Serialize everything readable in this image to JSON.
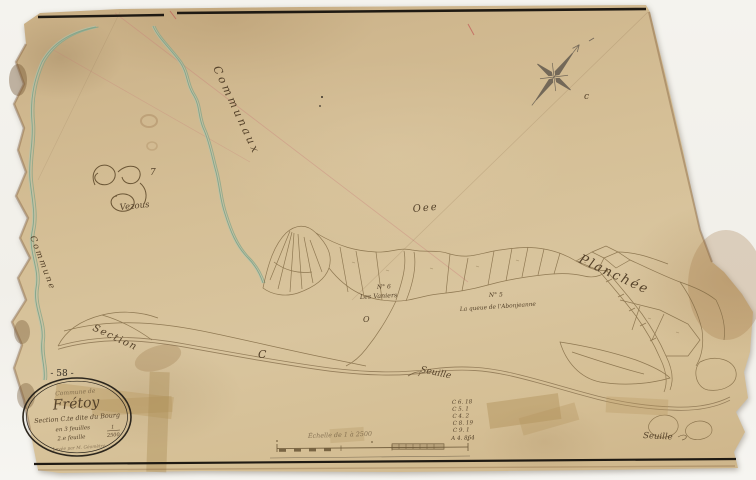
{
  "map": {
    "sheet_number": "- 58 -",
    "cartouche": {
      "commune_line": "Commune de",
      "title": "Frétoy",
      "section_line": "Section C.te dite du Bourg",
      "feuilles_line": "en 3 feuilles",
      "feuille_line": "2.e feuille",
      "scale_numerator": "1",
      "scale_denominator": "2500",
      "surveyor_line": "Levée par M. Géomètre"
    },
    "labels": {
      "communaux": "Communaux",
      "commune_left": "Commune",
      "vezous_number": "7",
      "vezous": "Vezous",
      "oee": "Oee",
      "planchee": "Planchée",
      "section": "Section",
      "parcel6_number": "N° 6",
      "parcel6_name": "Les Vaniers",
      "parcel5_number": "N° 5",
      "parcel5_name": "La queue de l'Abonjeanne",
      "seuille_center": "Seuille",
      "seuille_right": "Seuille",
      "stray_c": "C",
      "stray_o": "O",
      "compass_mark": "c"
    },
    "scale_bar": {
      "caption": "Échelle de 1 à 2500"
    },
    "notes": [
      "C 6. 18",
      "C 5. 1",
      "C 4. 2",
      "C 8. 19",
      "C 9. 1",
      "A 4. 864"
    ]
  }
}
